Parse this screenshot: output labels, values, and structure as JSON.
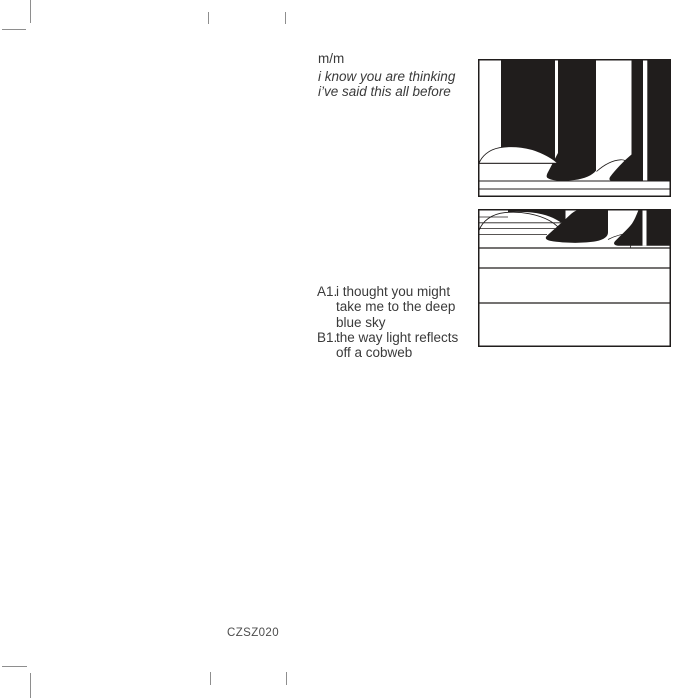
{
  "header": {
    "artist": "m/m",
    "title_lines": [
      "i know you are thinking",
      "i’ve said this all before"
    ]
  },
  "tracklist": {
    "tracks": [
      {
        "label": "A1.",
        "lines": [
          "i thought you might",
          "take me to the deep",
          "blue sky"
        ]
      },
      {
        "label": "B1.",
        "lines": [
          "the way light reflects",
          "off a cobweb"
        ]
      }
    ]
  },
  "catalog_number": "CZSZ020",
  "colors": {
    "background": "#ffffff",
    "artwork_ink": "#201d1c",
    "text": "#3a3a3a",
    "catalog_text": "#4d4d4d",
    "crop_mark": "#8e8e8e"
  }
}
